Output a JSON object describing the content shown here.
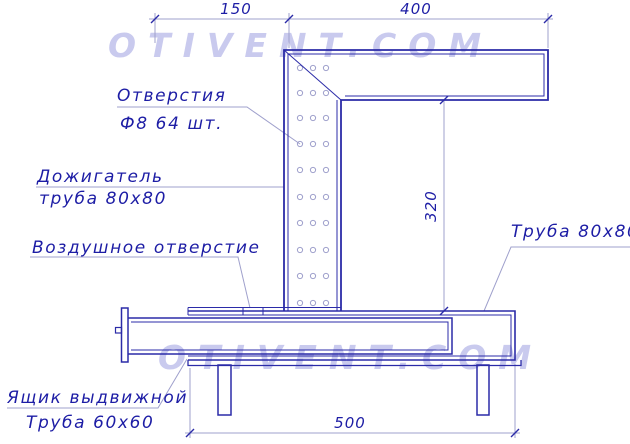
{
  "watermark": {
    "top": "OTIVENT.COM",
    "bottom": "OTIVENT.COM"
  },
  "dimensions": {
    "top_left": "150",
    "top_right": "400",
    "height": "320",
    "base_width": "500"
  },
  "labels": {
    "holes_line1": "Отверстия",
    "holes_line2": "Ф8 64 шт.",
    "afterburner_line1": "Дожигатель",
    "afterburner_line2": "труба 80x80",
    "air_opening": "Воздушное отверстие",
    "right_pipe": "Труба 80x80",
    "drawer_line1": "Ящик выдвижной",
    "drawer_line2": "Труба 60x60"
  },
  "holes_grid": {
    "columns": 3,
    "rows": 10,
    "note_total": "64"
  },
  "colors": {
    "line_main": "#2b2ba8",
    "line_thin": "#9fa0cc",
    "text": "#1d1da5",
    "watermark": "#c7c8ee"
  }
}
